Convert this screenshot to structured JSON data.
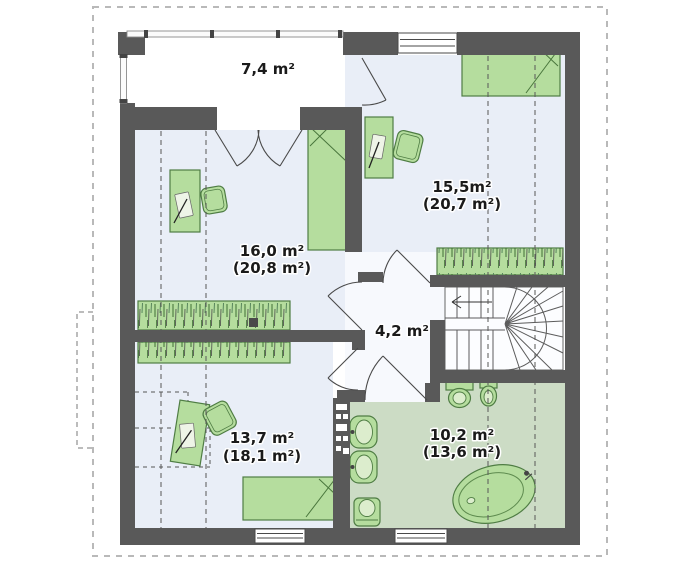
{
  "plan": {
    "rooms": [
      {
        "id": "terrace",
        "area_label": "7,4 m²",
        "area_sub": ""
      },
      {
        "id": "bedroom-right",
        "area_label": "15,5m²",
        "area_sub": "(20,7 m²)"
      },
      {
        "id": "bedroom-left",
        "area_label": "16,0 m²",
        "area_sub": "(20,8 m²)"
      },
      {
        "id": "hall",
        "area_label": "4,2 m²",
        "area_sub": ""
      },
      {
        "id": "bedroom-bottom",
        "area_label": "13,7 m²",
        "area_sub": "(18,1 m²)"
      },
      {
        "id": "bathroom",
        "area_label": "10,2 m²",
        "area_sub": "(13,6 m²)"
      }
    ],
    "colors": {
      "wall": "#595959",
      "room_floor": "#e9eef7",
      "bath_floor": "#ccdcc5",
      "hall_floor": "#f7f9fd",
      "terrace_floor": "#ffffff",
      "furniture_green": "#b5dd9e",
      "furniture_outline": "#4f7d44",
      "label_text": "#1a1a1a",
      "roof_outline_dash": "#b9b9b9"
    }
  }
}
